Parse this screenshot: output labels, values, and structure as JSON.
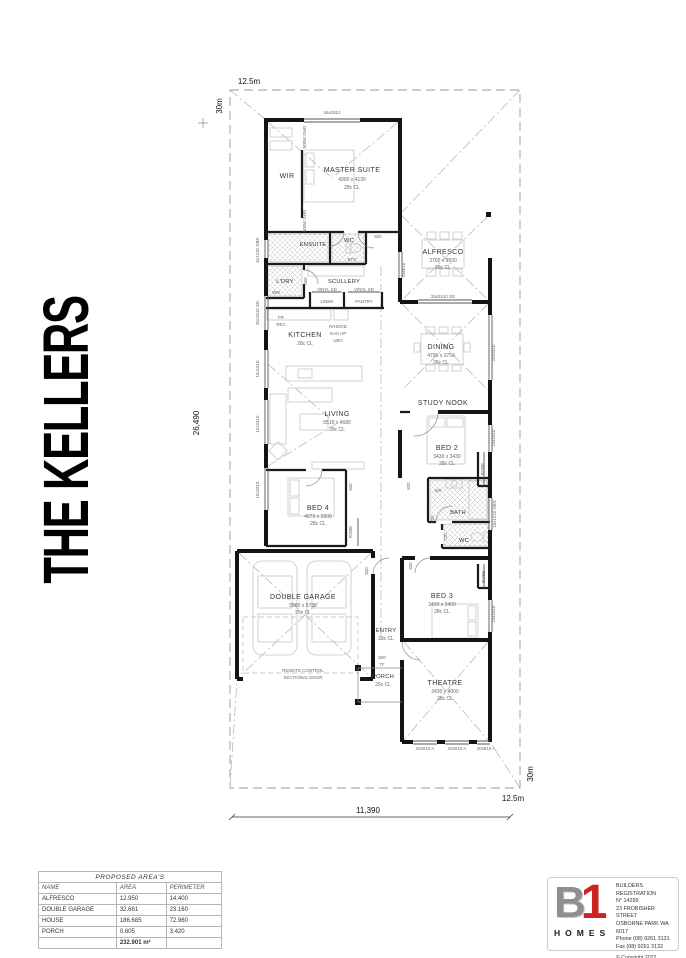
{
  "title": "THE KELLERS",
  "site": {
    "lot_width": "12.5m",
    "lot_depth": "30m",
    "dim_width": "11,390",
    "dim_depth": "26,490"
  },
  "rooms": {
    "master": {
      "name": "MASTER SUITE",
      "dims": "4300 x 4130",
      "ceil": "28c CL"
    },
    "wir": {
      "name": "WIR"
    },
    "ensuite": {
      "name": "ENSUITE"
    },
    "wc1": {
      "name": "WC"
    },
    "alfresco": {
      "name": "ALFRESCO",
      "dims": "3700 x 3500",
      "ceil": "28c CL"
    },
    "ldry": {
      "name": "L'DRY"
    },
    "scullery": {
      "name": "SCULLERY"
    },
    "kitchen": {
      "name": "KITCHEN",
      "ceil": "28c CL"
    },
    "dining": {
      "name": "DINING",
      "dims": "4700 x 3750",
      "ceil": "28c CL"
    },
    "study": {
      "name": "STUDY NOOK"
    },
    "living": {
      "name": "LIVING",
      "dims": "5510 x 4680",
      "ceil": "28c CL"
    },
    "bed2": {
      "name": "BED 2",
      "dims": "3430 x 3430",
      "ceil": "28c CL"
    },
    "bed4": {
      "name": "BED 4",
      "dims": "4070 x 2900",
      "ceil": "28c CL"
    },
    "bath": {
      "name": "BATH"
    },
    "wc2": {
      "name": "WC"
    },
    "garage": {
      "name": "DOUBLE GARAGE",
      "dims": "5980 x 5785",
      "ceil": "25c CL"
    },
    "entry": {
      "name": "ENTRY",
      "ceil": "28c CL"
    },
    "porch": {
      "name": "PORCH",
      "ceil": "25c CL"
    },
    "bed3": {
      "name": "BED 3",
      "dims": "3430 x 3400",
      "ceil": "28c CL"
    },
    "theatre": {
      "name": "THEATRE",
      "dims": "3430 x 4000",
      "ceil": "28c CL"
    }
  },
  "labels": {
    "door820": "820",
    "tf": "TF",
    "door720": "720",
    "robe": "ROBE",
    "vinylsd": "VINYL SD",
    "linen": "LINEN",
    "pantry": "PANTRY",
    "wm": "WM",
    "fr": "FR",
    "rec": "REC",
    "rhood": "R/HOOD",
    "gashp": "GAS HP",
    "ubo": "UBO",
    "bto": "BTO",
    "sr": "S/R",
    "dho": "500W DHO",
    "remote1": "REMOTE CONTROL",
    "remote2": "SECTIONAL DOOR",
    "win16x1810": "16x1810",
    "win25x610": "25x610",
    "win25x2410sd": "25x2410 SD",
    "win25x2410": "25x2410",
    "win16x1210obs": "16x1210 OBS",
    "win6x1210obs": "6x1210 OBS",
    "win25x1510sd": "25x1510 SD",
    "win16x1510": "16x1510",
    "win16x2410": "16x2410",
    "win20x610a": "20x610 A"
  },
  "areas_table": {
    "title": "PROPOSED AREA'S",
    "headers": [
      "NAME",
      "AREA",
      "PERIMETER"
    ],
    "rows": [
      [
        "ALFRESCO",
        "12.950",
        "14.400"
      ],
      [
        "DOUBLE GARAGE",
        "32.661",
        "23.160"
      ],
      [
        "HOUSE",
        "186.685",
        "72.960"
      ],
      [
        "PORCH",
        "0.605",
        "3.420"
      ]
    ],
    "total": "232.901 m²"
  },
  "brand": {
    "b": "B",
    "one": "1",
    "homes": "HOMES",
    "reg_lines": [
      "BUILDERS REGISTRATION",
      "N° 14299",
      "23 FROBISHER STREET",
      "OSBORNE PARK WA 6017",
      "Phone (08) 9261 3131",
      "Fax (08) 9261 3132"
    ],
    "copyright": "© Copyright 2022"
  }
}
